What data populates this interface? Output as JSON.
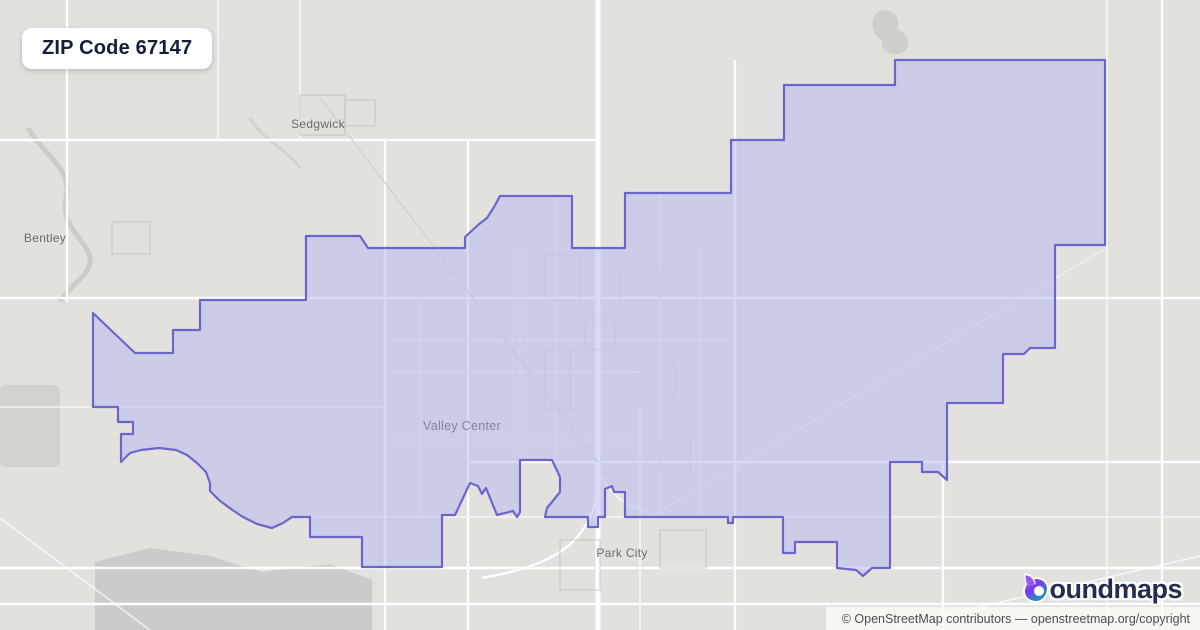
{
  "title": {
    "label": "ZIP Code 67147"
  },
  "map": {
    "zone": {
      "zip": "67147",
      "fill_color": "#d1d4ee",
      "stroke_color": "#6b66cc"
    },
    "place_labels": [
      {
        "name": "Sedgwick"
      },
      {
        "name": "Bentley"
      },
      {
        "name": "Valley Center"
      },
      {
        "name": "Park City"
      }
    ]
  },
  "branding": {
    "brand": "boundmaps",
    "logo_text": "oundmaps"
  },
  "attribution": {
    "text": "© OpenStreetMap contributors — openstreetmap.org/copyright"
  }
}
